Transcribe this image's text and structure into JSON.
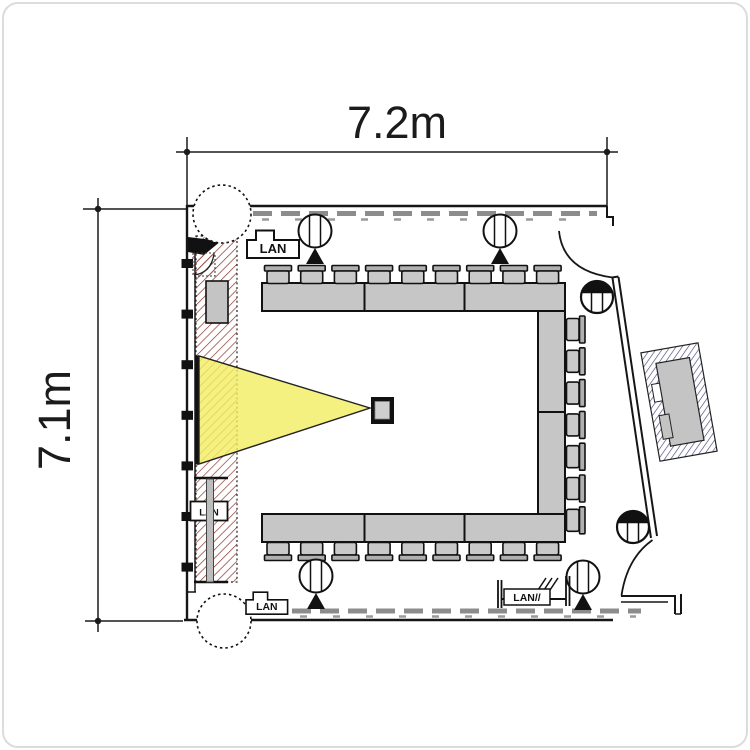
{
  "diagram": {
    "type": "floor-plan",
    "title": "meeting-room-floor-plan",
    "room": {
      "width_label": "7.2m",
      "height_label": "7.1m"
    },
    "outlets": [
      {
        "kind": "house",
        "label": "LAN",
        "x": 247,
        "y": 229,
        "scale": 1
      },
      {
        "kind": "house",
        "label": "LAN",
        "x": 246,
        "y": 591,
        "scale": 0.8
      },
      {
        "kind": "plain",
        "label": "LAN",
        "x": 190.5,
        "y": 501.5,
        "w": 37,
        "h": 19
      },
      {
        "kind": "assembly",
        "label": "LAN//",
        "x": 504,
        "y": 589,
        "w": 46,
        "h": 16
      }
    ],
    "furniture": {
      "table_segments": {
        "top": 3,
        "right": 2,
        "bottom": 3
      },
      "chairs": {
        "top": {
          "count": 9,
          "x0": 264.5,
          "step": 33.7,
          "w": 27
        },
        "bottom": {
          "count": 9,
          "x0": 264.5,
          "step": 33.7,
          "w": 27
        },
        "right": {
          "count": 7,
          "y0": 316,
          "step": 31.8,
          "w": 27
        }
      }
    },
    "fixtures": {
      "ceiling_speakers": [
        {
          "cx": 315,
          "cy": 231
        },
        {
          "cx": 500,
          "cy": 231
        },
        {
          "cx": 316,
          "cy": 576
        },
        {
          "cx": 583,
          "cy": 577
        }
      ],
      "downlights": [
        {
          "cx": 597,
          "cy": 297
        },
        {
          "cx": 633,
          "cy": 527
        }
      ],
      "columns": [
        {
          "cx": 222,
          "cy": 214,
          "r": 29
        },
        {
          "cx": 224,
          "cy": 621,
          "r": 27
        }
      ],
      "wall_mullions": {
        "count": 7,
        "y0": 259,
        "step": 50.6
      }
    },
    "colors": {
      "line": "#161616",
      "table_fill": "#c6c6c6",
      "chair_fill": "#c9c9c9",
      "chair_back": "#b0b0b0",
      "cone_fill": "#f3ed60",
      "screen_hatch": "#8e3b33",
      "ac_hatch": "#44447c",
      "window_dash": "#8c8c8c",
      "gray_bar": "#bdbdbd"
    }
  }
}
